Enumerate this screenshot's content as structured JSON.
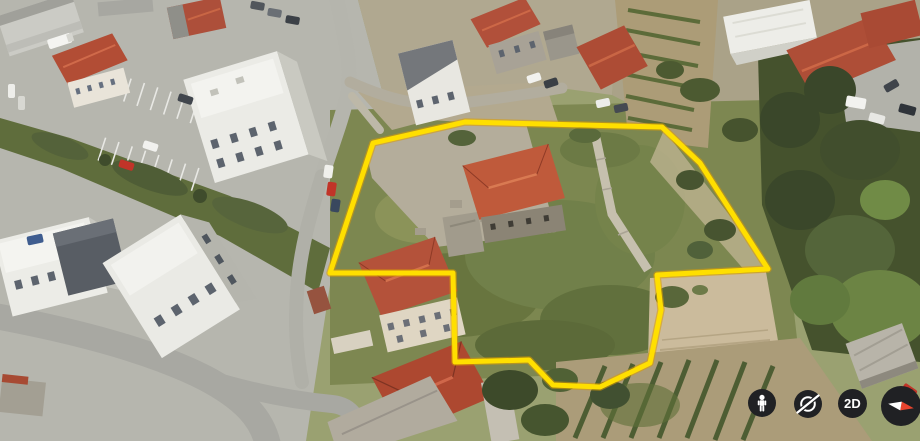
{
  "map": {
    "imagery_type": "3D aerial",
    "parcel": {
      "outline_color": "#ffdf00",
      "glow_color": "#dd9c00",
      "points": [
        [
          373,
          143
        ],
        [
          465,
          122
        ],
        [
          662,
          127
        ],
        [
          700,
          163
        ],
        [
          768,
          269
        ],
        [
          657,
          275
        ],
        [
          661,
          310
        ],
        [
          650,
          363
        ],
        [
          600,
          387
        ],
        [
          553,
          385
        ],
        [
          529,
          360
        ],
        [
          455,
          362
        ],
        [
          453,
          273
        ],
        [
          330,
          273
        ]
      ]
    }
  },
  "controls": {
    "background_color": "#202124",
    "compass_red": "#e8442e",
    "compass_white": "#ffffff",
    "buttons": [
      {
        "id": "street-view",
        "icon": "pegman-icon"
      },
      {
        "id": "orbit",
        "icon": "orbit-icon"
      },
      {
        "id": "2d-toggle",
        "label": "2D"
      },
      {
        "id": "compass",
        "icon": "compass-icon",
        "needle_rotation_deg": 100
      }
    ]
  }
}
